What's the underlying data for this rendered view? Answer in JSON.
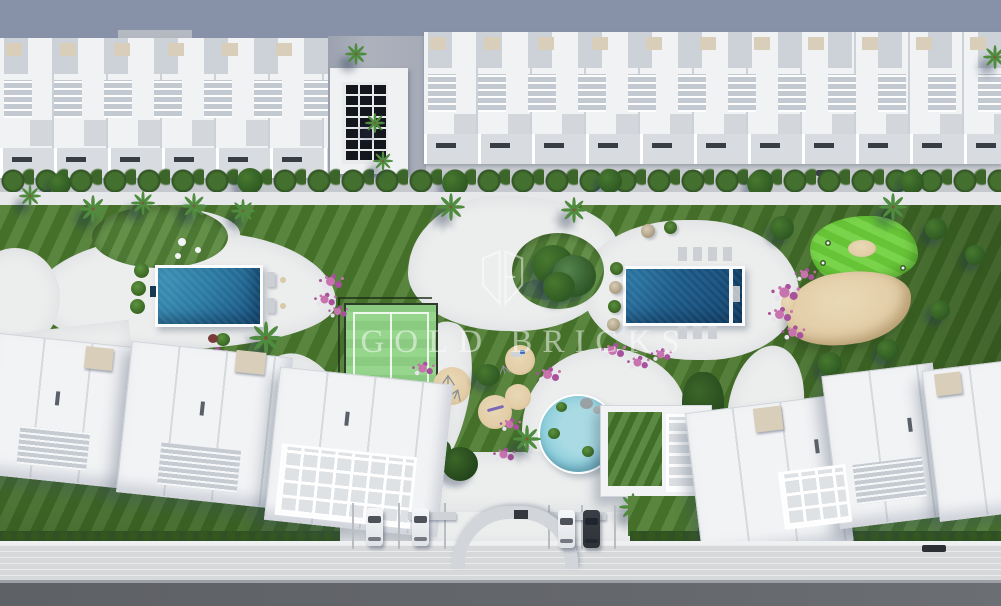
{
  "window": {
    "title": "Aerial 3D site-plan render of a residential complex"
  },
  "watermark": {
    "brand_name": "GOLD BRICKS",
    "logo": "gold-bricks-open-book-logo"
  },
  "scene": {
    "description": "Top-down render: row of white townhouses with roof terraces at top, landscaped striped lawn with two rectangular pools, round kids pool, padel court, playground sand circles, putting green with sand bunker, community building with green roof, two white apartment blocks at bottom corners, entrance arch, parking with cars, sidewalk and road at bottom edge.",
    "features": [
      "townhouse-row",
      "courtyard-solar-panels",
      "street-hedge",
      "left-pool",
      "right-pool",
      "kids-pool",
      "padel-court",
      "playground",
      "putting-green",
      "sand-bunker",
      "community-building",
      "center-island-tree",
      "entrance-arch",
      "parking-cars",
      "palm-trees",
      "flower-beds",
      "striped-lawn",
      "bottom-left-apartments",
      "bottom-right-apartments",
      "sidewalk",
      "road"
    ],
    "counts": {
      "main_pools": 2,
      "round_pools": 1,
      "foreground_parked_cars": 4,
      "padel_courts": 1,
      "entrance_arches": 1
    }
  },
  "colors": {
    "bg_pavement": "#b5b9c1",
    "shadow_blue": "#7f89a2",
    "building_white": "#f0f2f4",
    "roof_gray": "#ccd1d7",
    "awning_dark": "#383d44",
    "bulkhead_tan": "#d9ceba",
    "solar_dark": "#14171d",
    "hedge_dark": "#2f5124",
    "hedge_light": "#44702f",
    "lawn_base": "#4c7b2e",
    "lawn_shade": "#2f5420",
    "path_white": "#eceded",
    "pool_water_light": "#3e93b8",
    "pool_water_dark": "#12446e",
    "kids_pool": "#8fd0dd",
    "padel_court": "#90d386",
    "padel_fence": "#2c3d2a",
    "putting_green_a": "#67c437",
    "putting_green_b": "#7ad44b",
    "sand": "#e2cda7",
    "flower_pink": "#c873ae",
    "flower_magenta": "#a8519d",
    "flower_white": "#e8e3ee",
    "tree_dark": "#2f5a23",
    "tree_mid": "#47792f",
    "green_roof": "#4a7c2e",
    "car_dark": "#2e3238",
    "road": "#64676c",
    "sidewalk": "#d6d8da",
    "watermark": "rgba(255,255,255,0.5)"
  }
}
